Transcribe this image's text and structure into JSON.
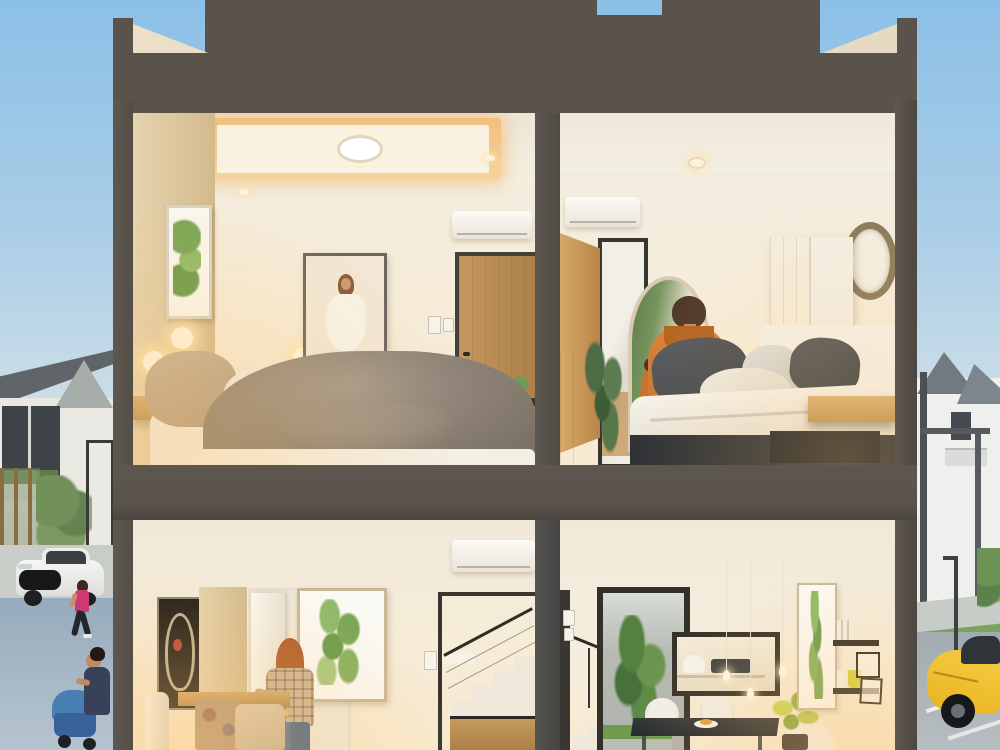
{
  "meta": {
    "image_type": "3d-architectural-render",
    "description": "Dollhouse cross-section rendering of a two-storey townhouse at dusk, four rooms visible, residential street on both sides"
  },
  "palette": {
    "sky_top": "#8cc0e7",
    "sky_horizon": "#efe9dd",
    "structure_gray": "#59534c",
    "interior_cream": "#f5ecdb",
    "cove_light_orange": "#f0b566",
    "wood_light": "#d2a96b",
    "duvet_gray": "#8e8376",
    "hoodie_orange": "#d0792f",
    "leaf_green": "#7fae5d",
    "car_yellow": "#f2c230",
    "car_white": "#f0f0ee",
    "road_blue_gray": "#96abbd"
  },
  "building": {
    "floors": [
      {
        "name": "upper",
        "rooms": [
          {
            "name": "master-bedroom",
            "objects": [
              "tray-ceiling-cove-light",
              "round-ceiling-lamp",
              "wood-accent-wall",
              "plant-art-frame",
              "wall-sconces",
              "portrait-art-frame",
              "air-conditioner",
              "wood-door",
              "light-switch",
              "gray-duvet-bed",
              "beige-pillows",
              "floating-nightstand",
              "photo-frame",
              "door-side-plant-shelf"
            ]
          },
          {
            "name": "second-bedroom",
            "objects": [
              "recessed-downlight",
              "air-conditioner",
              "open-wood-door",
              "framed-mirror-panel",
              "arched-mirror",
              "person-orange-hoodie",
              "mirror-reflection",
              "wardrobe",
              "round-wall-decor",
              "white-duvet-bed",
              "charcoal-pillows",
              "floating-nightstand",
              "potted-plant",
              "side-cabinet",
              "blue-vase"
            ]
          }
        ]
      },
      {
        "name": "ground",
        "rooms": [
          {
            "name": "living-room",
            "objects": [
              "air-conditioner",
              "abstract-art-frame",
              "wood-panel",
              "open-white-door",
              "leaf-art-frame",
              "woman-plaid-shirt",
              "yellow-handled-tool",
              "light-switch",
              "staircase-cable-railing",
              "white-stairs",
              "under-stair-cabinet",
              "bench-cushions",
              "white-vase"
            ]
          },
          {
            "name": "dining-kitchen",
            "objects": [
              "stair-railing",
              "light-switches",
              "backyard-doorway",
              "garden-greenery",
              "kitchen-pass-window",
              "pendant-lights",
              "dining-table",
              "white-chairs",
              "food-plate",
              "yellow-green-plant",
              "leaf-art-frame",
              "wall-shelves",
              "yellow-cup",
              "small-frames"
            ]
          }
        ]
      }
    ]
  },
  "exterior": {
    "left": {
      "objects": [
        "neighbor-house-dark-roof",
        "balcony-windows",
        "wood-fence",
        "gate",
        "white-muscle-car",
        "jogging-woman-pink-top",
        "woman-with-blue-stroller",
        "blue-gray-pavement"
      ]
    },
    "right": {
      "objects": [
        "white-houses-gray-roofs",
        "porch-posts",
        "street-lamp",
        "sidewalk",
        "green-strip",
        "yellow-sports-car",
        "palm-greenery",
        "road-markings"
      ]
    }
  },
  "aria": {
    "scene": "Cross-section render of two-storey house",
    "upper_left_room": "Upper floor master bedroom",
    "upper_right_room": "Upper floor second bedroom",
    "lower_left_room": "Ground floor living room",
    "lower_right_room": "Ground floor dining and kitchen",
    "exterior_left": "Street scene left of house",
    "exterior_right": "Street scene right of house",
    "structure": "Dark gray concrete shell and parapet"
  }
}
